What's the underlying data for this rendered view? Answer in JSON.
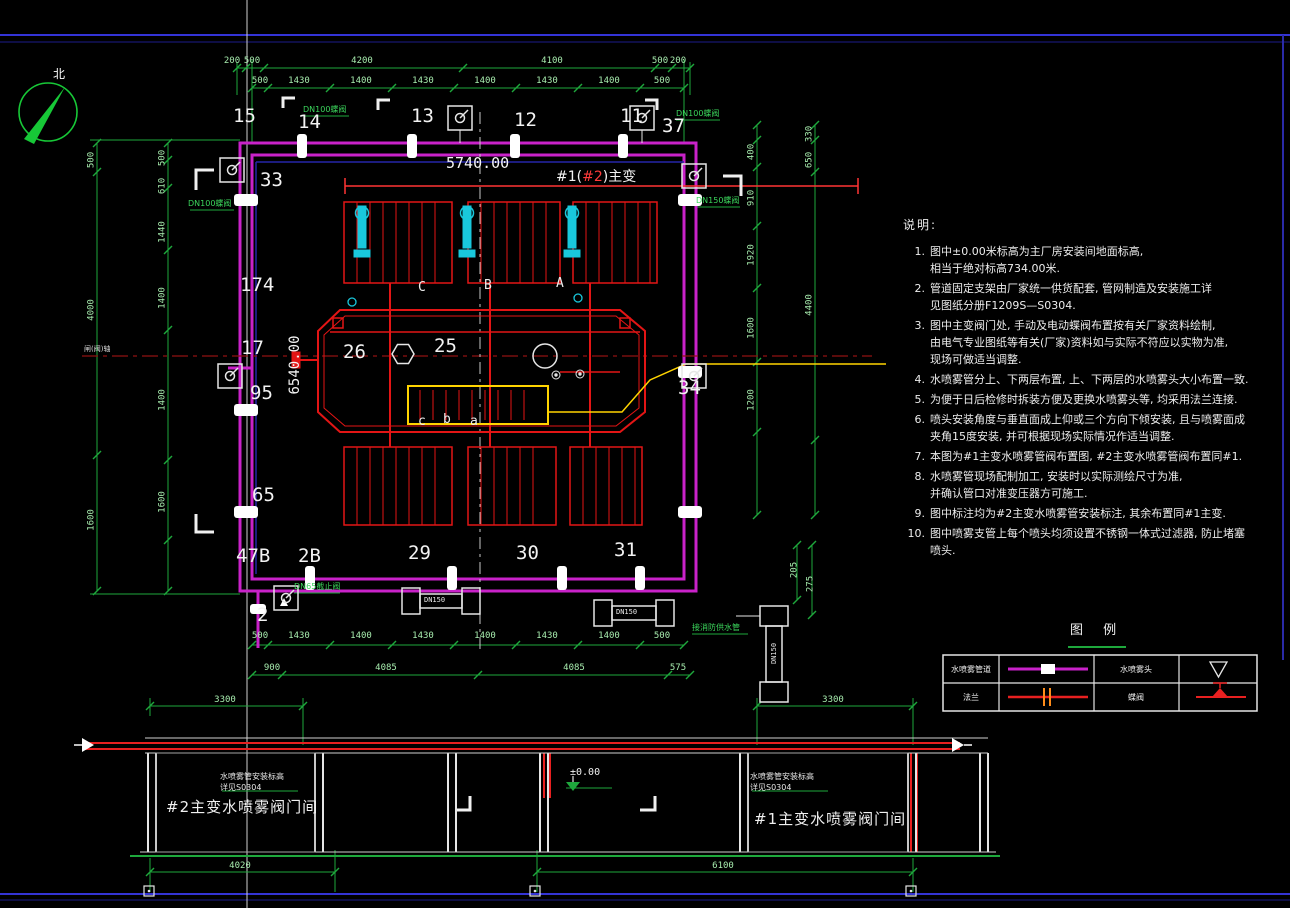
{
  "compass": {
    "north": "北"
  },
  "plan": {
    "dim_width": "5740.00",
    "dim_height": "6540.00",
    "tag_pre": "#1(",
    "tag_num": "#2",
    "tag_post": ")主变",
    "axis_label": "闸(阀)轴",
    "spool": "DN150",
    "nodes": {
      "t1": "15",
      "t2": "14",
      "t3": "13",
      "t4": "12",
      "t5": "11",
      "t6": "37",
      "l1": "33",
      "l2": "174",
      "l3": "17",
      "l4": "95",
      "l5": "65",
      "b1": "47B",
      "b2": "2B",
      "b3": "29",
      "b4": "30",
      "b5": "31",
      "b6": "2",
      "r1": "34",
      "c1": "26",
      "c2": "25"
    },
    "phases": {
      "A": "A",
      "B": "B",
      "C": "C",
      "a": "a",
      "b": "b",
      "c": "c"
    }
  },
  "dims": {
    "top_outer": [
      "200",
      "500",
      "4200",
      "4100",
      "500",
      "200"
    ],
    "top_inner": [
      "500",
      "1430",
      "1400",
      "1430",
      "1400",
      "1430",
      "1400",
      "500"
    ],
    "left_outer": [
      "500",
      "4000",
      "1600"
    ],
    "left_inner": [
      "500",
      "610",
      "1440",
      "1400",
      "1400",
      "1600"
    ],
    "right_inner": [
      "400",
      "910",
      "1920",
      "1600",
      "1200"
    ],
    "right_outer": [
      "330",
      "650",
      "4400"
    ],
    "bottom_inner": [
      "500",
      "1430",
      "1400",
      "1430",
      "1400",
      "1430",
      "1400",
      "500"
    ],
    "bottom_outer": [
      "900",
      "4085",
      "4085",
      "575"
    ],
    "right_small": [
      "205",
      "275"
    ]
  },
  "green_notes": [
    "DN100蝶阀",
    "DN100蝶阀",
    "DN100蝶阀",
    "DN150蝶阀",
    "DN65截止阀",
    "接消防供水管"
  ],
  "sections": {
    "left": {
      "room": "#2主变水喷雾阀门间",
      "dim_top": "3300",
      "dim_bottom": "4020",
      "note": "水喷雾管安装标高\n详见S0304"
    },
    "right": {
      "room": "#1主变水喷雾阀门间",
      "dim_top": "3300",
      "dim_bottom": "6100",
      "note": "水喷雾管安装标高\n详见S0304"
    },
    "level": "±0.00"
  },
  "notes": {
    "title": "说明:",
    "items": [
      {
        "num": "1.",
        "text": "图中±0.00米标高为主厂房安装间地面标高,\n相当于绝对标高734.00米."
      },
      {
        "num": "2.",
        "text": "管道固定支架由厂家统一供货配套, 管网制造及安装施工详\n见图纸分册F1209S—S0304."
      },
      {
        "num": "3.",
        "text": "图中主变阀门处, 手动及电动蝶阀布置按有关厂家资料绘制,\n由电气专业图纸等有关(厂家)资料如与实际不符应以实物为准,\n现场可做适当调整."
      },
      {
        "num": "4.",
        "text": "水喷雾管分上、下两层布置, 上、下两层的水喷雾头大小布置一致."
      },
      {
        "num": "5.",
        "text": "为便于日后检修时拆装方便及更换水喷雾头等, 均采用法兰连接."
      },
      {
        "num": "6.",
        "text": "喷头安装角度与垂直面成上仰或三个方向下倾安装, 且与喷雾面成\n夹角15度安装, 并可根据现场实际情况作适当调整."
      },
      {
        "num": "7.",
        "text": "本图为#1主变水喷雾管阀布置图, #2主变水喷雾管阀布置同#1."
      },
      {
        "num": "8.",
        "text": "水喷雾管现场配制加工, 安装时以实际测绘尺寸为准,\n并确认管口对准变压器方可施工."
      },
      {
        "num": "9.",
        "text": "图中标注均为#2主变水喷雾管安装标注, 其余布置同#1主变."
      },
      {
        "num": "10.",
        "text": "图中喷雾支管上每个喷头均须设置不锈钢一体式过滤器, 防止堵塞喷头."
      }
    ]
  },
  "legend": {
    "title": "图 例",
    "pipe_label": "水喷雾管道",
    "nozzle_label": "水喷雾头",
    "flange_label": "法兰",
    "valve_label": "蝶阀"
  }
}
